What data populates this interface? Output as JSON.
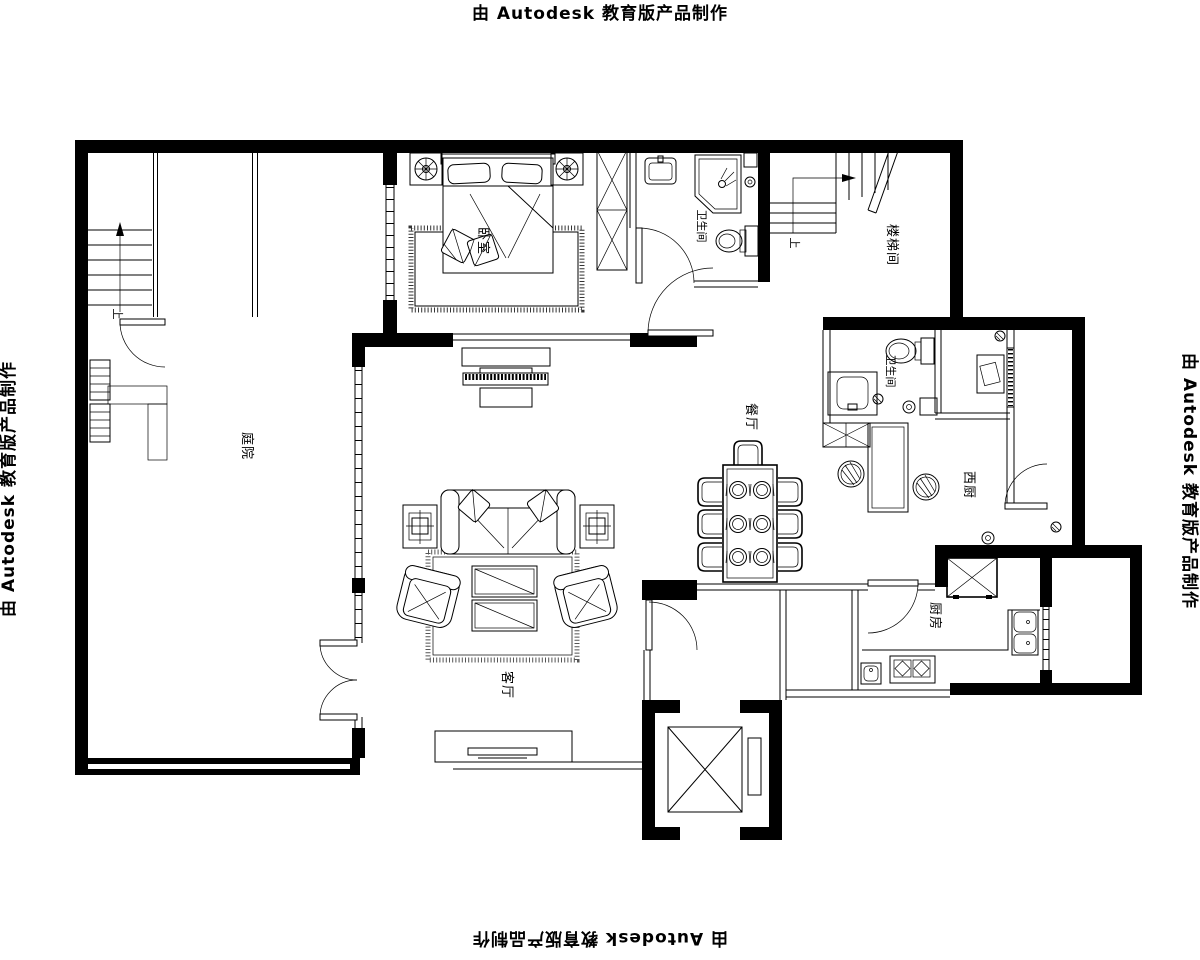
{
  "watermark": {
    "text": "由 Autodesk 教育版产品制作"
  },
  "rooms": {
    "courtyard": "庭院",
    "bedroom": "卧室",
    "bathroom_top": "卫生间",
    "stairwell": "楼梯间",
    "bathroom_mid": "卫生间",
    "dining": "餐厅",
    "west_kitchen": "西厨",
    "kitchen": "厨房",
    "living_room": "客厅"
  },
  "annotations": {
    "stairs_up_left": "上",
    "stairs_up_right": "上"
  },
  "colors": {
    "ink": "#000000",
    "background": "#ffffff"
  }
}
